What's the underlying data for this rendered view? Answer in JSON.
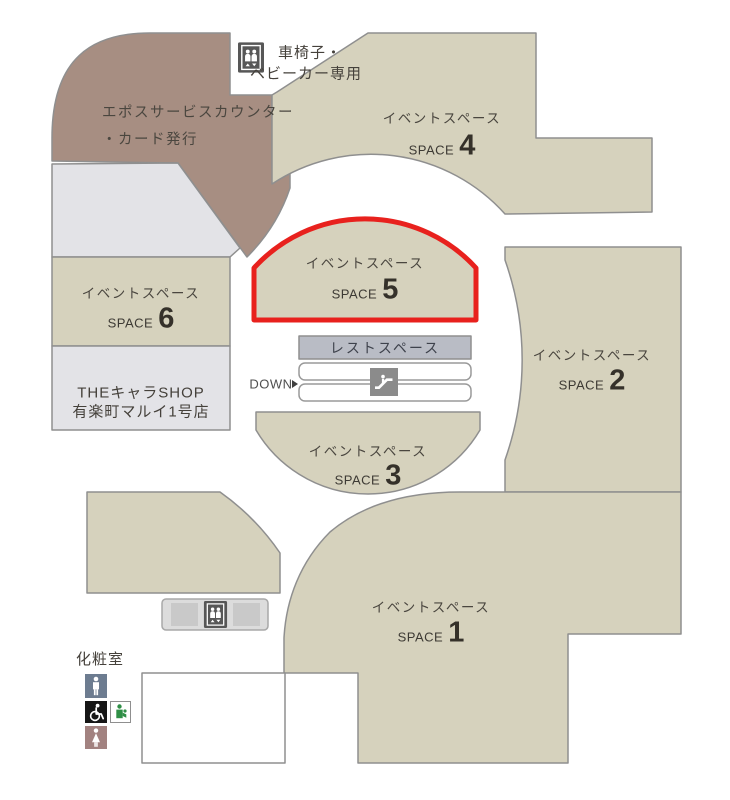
{
  "floor_map": {
    "wheelchair_note": {
      "line1": "車椅子・",
      "line2": "ベビーカー専用"
    },
    "epos_counter": {
      "line1": "エポスサービスカウンター",
      "line2": "・カード発行"
    },
    "spaces": {
      "s1": {
        "label": "イベントスペース",
        "space_word": "SPACE",
        "number": "1"
      },
      "s2": {
        "label": "イベントスペース",
        "space_word": "SPACE",
        "number": "2"
      },
      "s3": {
        "label": "イベントスペース",
        "space_word": "SPACE",
        "number": "3"
      },
      "s4": {
        "label": "イベントスペース",
        "space_word": "SPACE",
        "number": "4"
      },
      "s5": {
        "label": "イベントスペース",
        "space_word": "SPACE",
        "number": "5"
      },
      "s6": {
        "label": "イベントスペース",
        "space_word": "SPACE",
        "number": "6"
      }
    },
    "highlighted_space": "SPACE 5",
    "chara_shop": {
      "line1": "THEキャラSHOP",
      "line2": "有楽町マルイ1号店"
    },
    "rest_space_label": "レストスペース",
    "down_label": "DOWN",
    "restroom_label": "化粧室",
    "icons": {
      "elevator": "elevator-icon",
      "escalator": "escalator-icon",
      "restroom_male": "male-restroom-icon",
      "restroom_female": "female-restroom-icon",
      "restroom_accessible": "wheelchair-restroom-icon",
      "baby_care": "baby-care-icon"
    },
    "colors": {
      "highlight_red": "#e8211d",
      "event_space_fill": "#d6d2bd",
      "service_counter_brown": "#a78e82",
      "backroom_gray": "#e3e3e7",
      "rest_space_bar": "#b9bcc5",
      "outline_gray": "#8f8f8f"
    }
  }
}
